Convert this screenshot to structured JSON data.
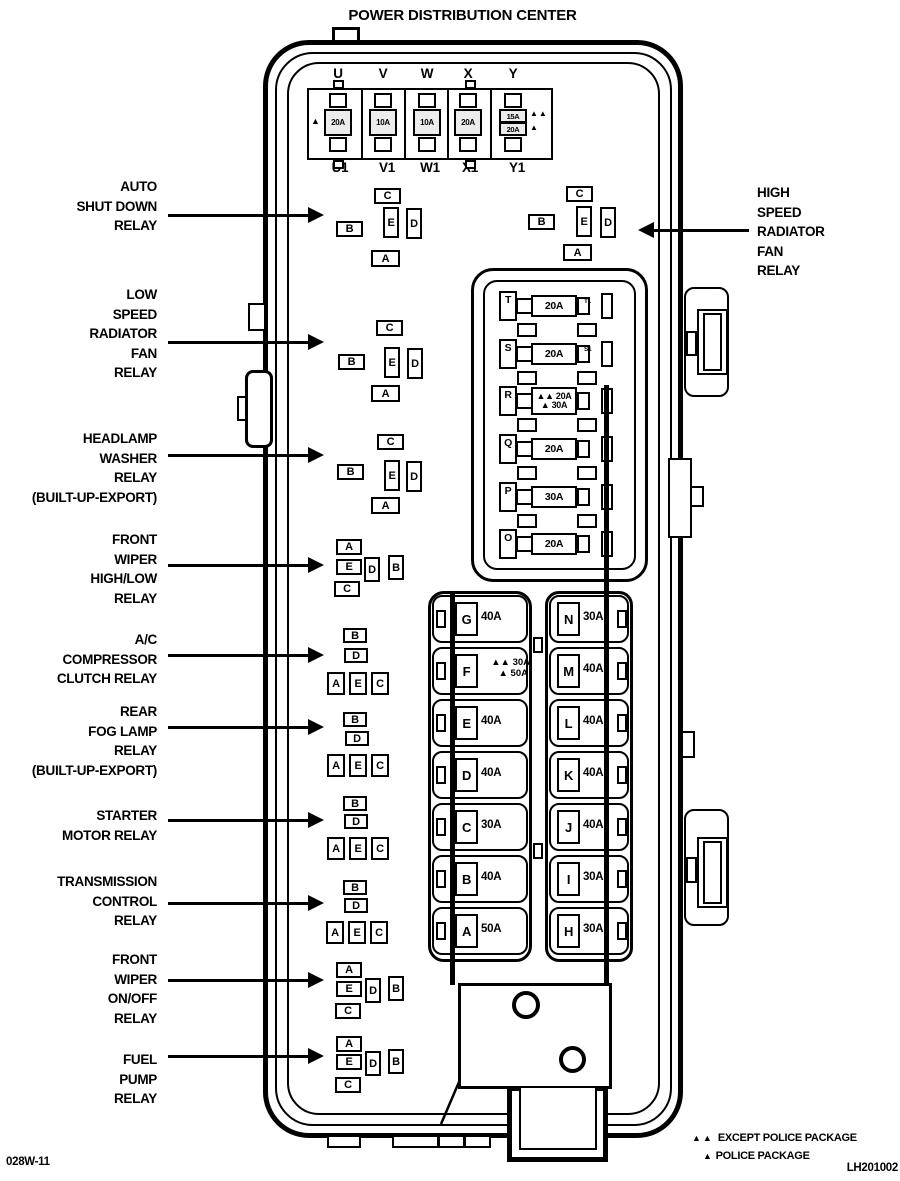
{
  "title": "POWER DISTRIBUTION CENTER",
  "codes": {
    "bottom_left": "028W-11",
    "bottom_right": "LH201002"
  },
  "legend": {
    "items": [
      {
        "symbol": "▲▲",
        "label": "EXCEPT POLICE PACKAGE"
      },
      {
        "symbol": "▲",
        "label": "POLICE PACKAGE"
      }
    ]
  },
  "top_fuse_row": {
    "top_labels": [
      "U",
      "V",
      "W",
      "X",
      "Y"
    ],
    "bottom_labels": [
      "U1",
      "V1",
      "W1",
      "X1",
      "Y1"
    ],
    "fuses": [
      {
        "position": "U",
        "amp": "20A",
        "marker": "▲"
      },
      {
        "position": "V",
        "amp": "10A",
        "marker": ""
      },
      {
        "position": "W",
        "amp": "10A",
        "marker": ""
      },
      {
        "position": "X",
        "amp": "20A",
        "marker": ""
      },
      {
        "position": "Y",
        "rows": [
          {
            "amp": "15A",
            "marker": "▲▲"
          },
          {
            "amp": "20A",
            "marker": "▲"
          }
        ]
      }
    ]
  },
  "callouts": {
    "left": [
      {
        "id": "auto-shut-down-relay",
        "lines": [
          "AUTO",
          "SHUT DOWN",
          "RELAY"
        ]
      },
      {
        "id": "low-speed-radiator-fan-relay",
        "lines": [
          "LOW",
          "SPEED",
          "RADIATOR",
          "FAN",
          "RELAY"
        ]
      },
      {
        "id": "headlamp-washer-relay",
        "lines": [
          "HEADLAMP",
          "WASHER",
          "RELAY",
          "(BUILT-UP-EXPORT)"
        ]
      },
      {
        "id": "front-wiper-high-low-relay",
        "lines": [
          "FRONT",
          "WIPER",
          "HIGH/LOW",
          "RELAY"
        ]
      },
      {
        "id": "ac-compressor-clutch-relay",
        "lines": [
          "A/C",
          "COMPRESSOR",
          "CLUTCH RELAY"
        ]
      },
      {
        "id": "rear-fog-lamp-relay",
        "lines": [
          "REAR",
          "FOG LAMP",
          "RELAY",
          "(BUILT-UP-EXPORT)"
        ]
      },
      {
        "id": "starter-motor-relay",
        "lines": [
          "STARTER",
          "MOTOR RELAY"
        ]
      },
      {
        "id": "transmission-control-relay",
        "lines": [
          "TRANSMISSION",
          "CONTROL",
          "RELAY"
        ]
      },
      {
        "id": "front-wiper-on-off-relay",
        "lines": [
          "FRONT",
          "WIPER",
          "ON/OFF",
          "RELAY"
        ]
      },
      {
        "id": "fuel-pump-relay",
        "lines": [
          "FUEL",
          "PUMP",
          "RELAY"
        ]
      }
    ],
    "right": [
      {
        "id": "high-speed-radiator-fan-relay",
        "lines": [
          "HIGH",
          "SPEED",
          "RADIATOR",
          "FAN",
          "RELAY"
        ]
      }
    ]
  },
  "relay_groups": [
    {
      "id": "auto-shut-down-relay",
      "pads": [
        "C",
        "B",
        "E",
        "D",
        "A"
      ]
    },
    {
      "id": "high-speed-radiator-fan-relay",
      "pads": [
        "C",
        "B",
        "E",
        "D",
        "A"
      ]
    },
    {
      "id": "low-speed-radiator-fan-relay",
      "pads": [
        "C",
        "B",
        "E",
        "D",
        "A"
      ]
    },
    {
      "id": "headlamp-washer-relay",
      "pads": [
        "C",
        "B",
        "E",
        "D",
        "A"
      ]
    },
    {
      "id": "front-wiper-high-low-relay",
      "pads": [
        "A",
        "E",
        "C",
        "D",
        "B"
      ]
    },
    {
      "id": "ac-compressor-clutch-relay",
      "pads": [
        "B",
        "D",
        "A",
        "E",
        "C"
      ]
    },
    {
      "id": "rear-fog-lamp-relay",
      "pads": [
        "B",
        "D",
        "A",
        "E",
        "C"
      ]
    },
    {
      "id": "starter-motor-relay",
      "pads": [
        "B",
        "D",
        "A",
        "E",
        "C"
      ]
    },
    {
      "id": "transmission-control-relay",
      "pads": [
        "B",
        "D",
        "A",
        "E",
        "C"
      ]
    },
    {
      "id": "front-wiper-on-off-relay",
      "pads": [
        "A",
        "E",
        "C",
        "D",
        "B"
      ]
    },
    {
      "id": "fuel-pump-relay",
      "pads": [
        "A",
        "E",
        "C",
        "D",
        "B"
      ]
    }
  ],
  "mid_fuse_panel": {
    "rows": [
      {
        "cavity": "T",
        "amp": "20A",
        "sub": "T1"
      },
      {
        "cavity": "S",
        "amp": "20A",
        "sub": "S1"
      },
      {
        "cavity": "R",
        "rows": [
          "▲▲ 20A",
          "▲ 30A"
        ]
      },
      {
        "cavity": "Q",
        "amp": "20A"
      },
      {
        "cavity": "P",
        "amp": "30A"
      },
      {
        "cavity": "O",
        "amp": "20A"
      }
    ]
  },
  "fuse_columns": {
    "left": [
      {
        "cavity": "G",
        "amp": "40A"
      },
      {
        "cavity": "F",
        "rows": [
          "▲▲ 30A",
          "▲ 50A"
        ]
      },
      {
        "cavity": "E",
        "amp": "40A"
      },
      {
        "cavity": "D",
        "amp": "40A"
      },
      {
        "cavity": "C",
        "amp": "30A"
      },
      {
        "cavity": "B",
        "amp": "40A"
      },
      {
        "cavity": "A",
        "amp": "50A"
      }
    ],
    "right": [
      {
        "cavity": "N",
        "amp": "30A"
      },
      {
        "cavity": "M",
        "amp": "40A"
      },
      {
        "cavity": "L",
        "amp": "40A"
      },
      {
        "cavity": "K",
        "amp": "40A"
      },
      {
        "cavity": "J",
        "amp": "40A"
      },
      {
        "cavity": "I",
        "amp": "30A"
      },
      {
        "cavity": "H",
        "amp": "30A"
      }
    ]
  }
}
